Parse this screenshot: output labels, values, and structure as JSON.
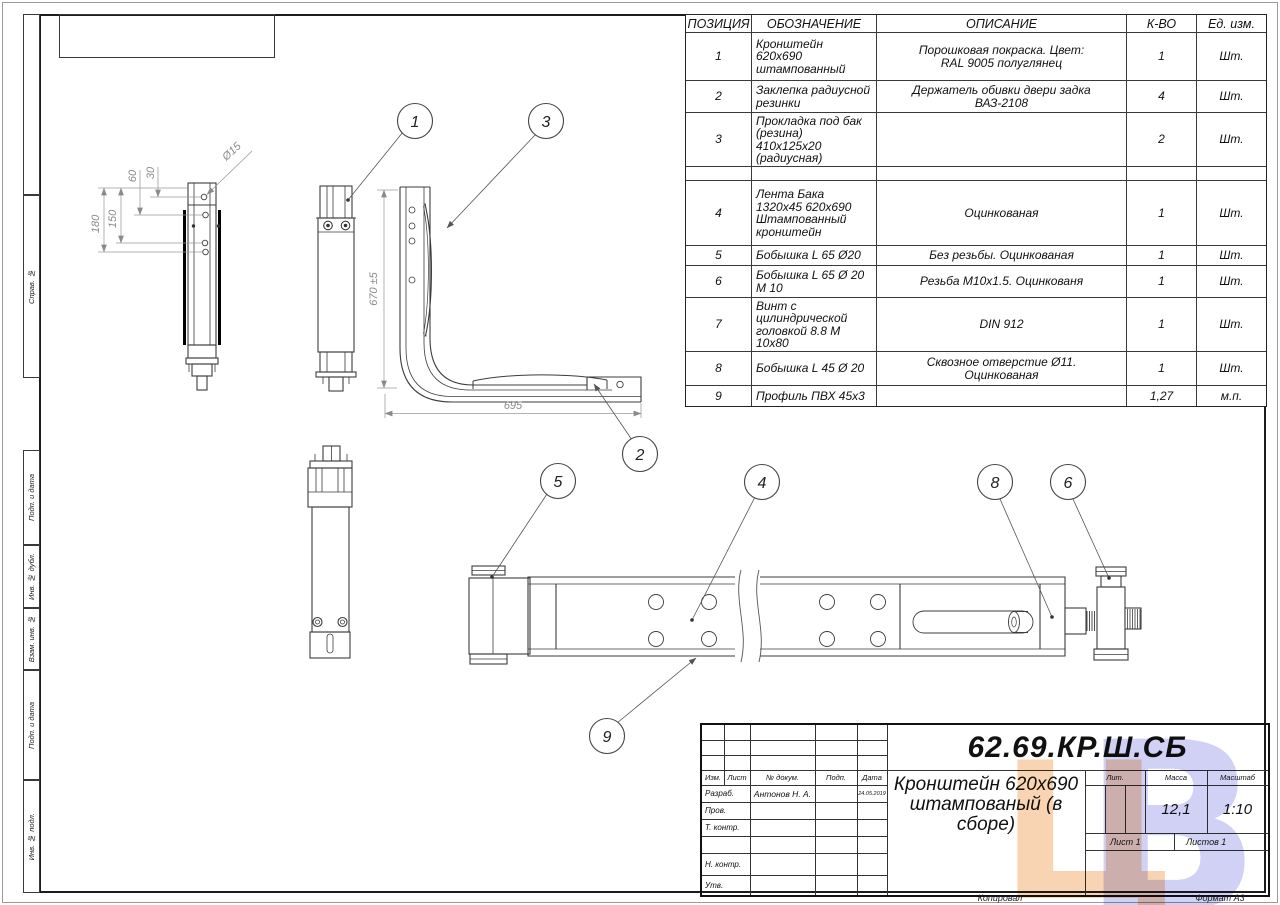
{
  "margin": {
    "labels": [
      "Справ. №",
      "Подп. и дата",
      "Инв. № дубл.",
      "Взам. инв. №",
      "Подп. и дата",
      "Инв. № подл."
    ]
  },
  "bom": {
    "headers": [
      "ПОЗИЦИЯ",
      "ОБОЗНАЧЕНИЕ",
      "ОПИСАНИЕ",
      "К-ВО",
      "Ед. изм."
    ],
    "rows": [
      {
        "pos": "1",
        "name": "Кронштейн\n620х690\nштампованный",
        "desc": "Порошковая покраска. Цвет:\nRAL 9005 полуглянец",
        "qty": "1",
        "unit": "Шт."
      },
      {
        "pos": "2",
        "name": "Заклепка радиусной\nрезинки",
        "desc": "Держатель обивки двери задка\nВАЗ-2108",
        "qty": "4",
        "unit": "Шт."
      },
      {
        "pos": "3",
        "name": "Прокладка под бак\n(резина)\n410х125х20\n(радиусная)",
        "desc": "",
        "qty": "2",
        "unit": "Шт."
      },
      {
        "pos": "",
        "name": "",
        "desc": "",
        "qty": "",
        "unit": ""
      },
      {
        "pos": "4",
        "name": "Лента Бака\n1320х45 620х690\nШтампованный\nкронштейн",
        "desc": "Оцинкованая",
        "qty": "1",
        "unit": "Шт."
      },
      {
        "pos": "5",
        "name": "Бобышка L 65 Ø20",
        "desc": "Без резьбы. Оцинкованая",
        "qty": "1",
        "unit": "Шт."
      },
      {
        "pos": "6",
        "name": "Бобышка L 65 Ø 20\nМ 10",
        "desc": "Резьба М10х1.5. Оцинкованя",
        "qty": "1",
        "unit": "Шт."
      },
      {
        "pos": "7",
        "name": "Винт с\nцилиндрической\nголовкой 8.8 М\n10х80",
        "desc": "DIN 912",
        "qty": "1",
        "unit": "Шт."
      },
      {
        "pos": "8",
        "name": "Бобышка L 45 Ø 20",
        "desc": "Сквозное отверстие Ø11.\nОцинкованая",
        "qty": "1",
        "unit": "Шт."
      },
      {
        "pos": "9",
        "name": "Профиль ПВХ 45х3",
        "desc": "",
        "qty": "1,27",
        "unit": "м.п."
      }
    ]
  },
  "views": {
    "balloons": {
      "b1": "1",
      "b2": "2",
      "b3": "3",
      "b4": "4",
      "b5": "5",
      "b6": "6",
      "b8": "8",
      "b9": "9"
    },
    "dims": {
      "d15": "Ø15",
      "d60": "60",
      "d30": "30",
      "d180": "180",
      "d150": "150",
      "d670": "670 ±5",
      "d695": "695"
    }
  },
  "title_block": {
    "designation": "62.69.КР.Ш.СБ",
    "title": "Кронштейн 620х690\nштампованый (в сборе)",
    "cols": {
      "izm": "Изм.",
      "list": "Лист",
      "doc": "№ докум.",
      "podp": "Подп.",
      "date": "Дата"
    },
    "sig": {
      "razrab": "Разраб.",
      "prov": "Пров.",
      "tkontr": "Т. контр.",
      "nkontr": "Н. контр.",
      "utv": "Утв."
    },
    "razrab_name": "Антонов Н. А.",
    "razrab_date": "24.05.2019",
    "lit_label": "Лит.",
    "mass_label": "Масса",
    "scale_label": "Масштаб",
    "mass": "12,1",
    "scale": "1:10",
    "sheet": "Лист 1",
    "sheets": "Листов 1"
  },
  "footer": {
    "kopiroval": "Копировал",
    "format": "Формат А3"
  },
  "watermark": {
    "l1": "Ц",
    "l2": "В",
    "color1": "#f8cda6",
    "color2": "#c9c9f4"
  }
}
